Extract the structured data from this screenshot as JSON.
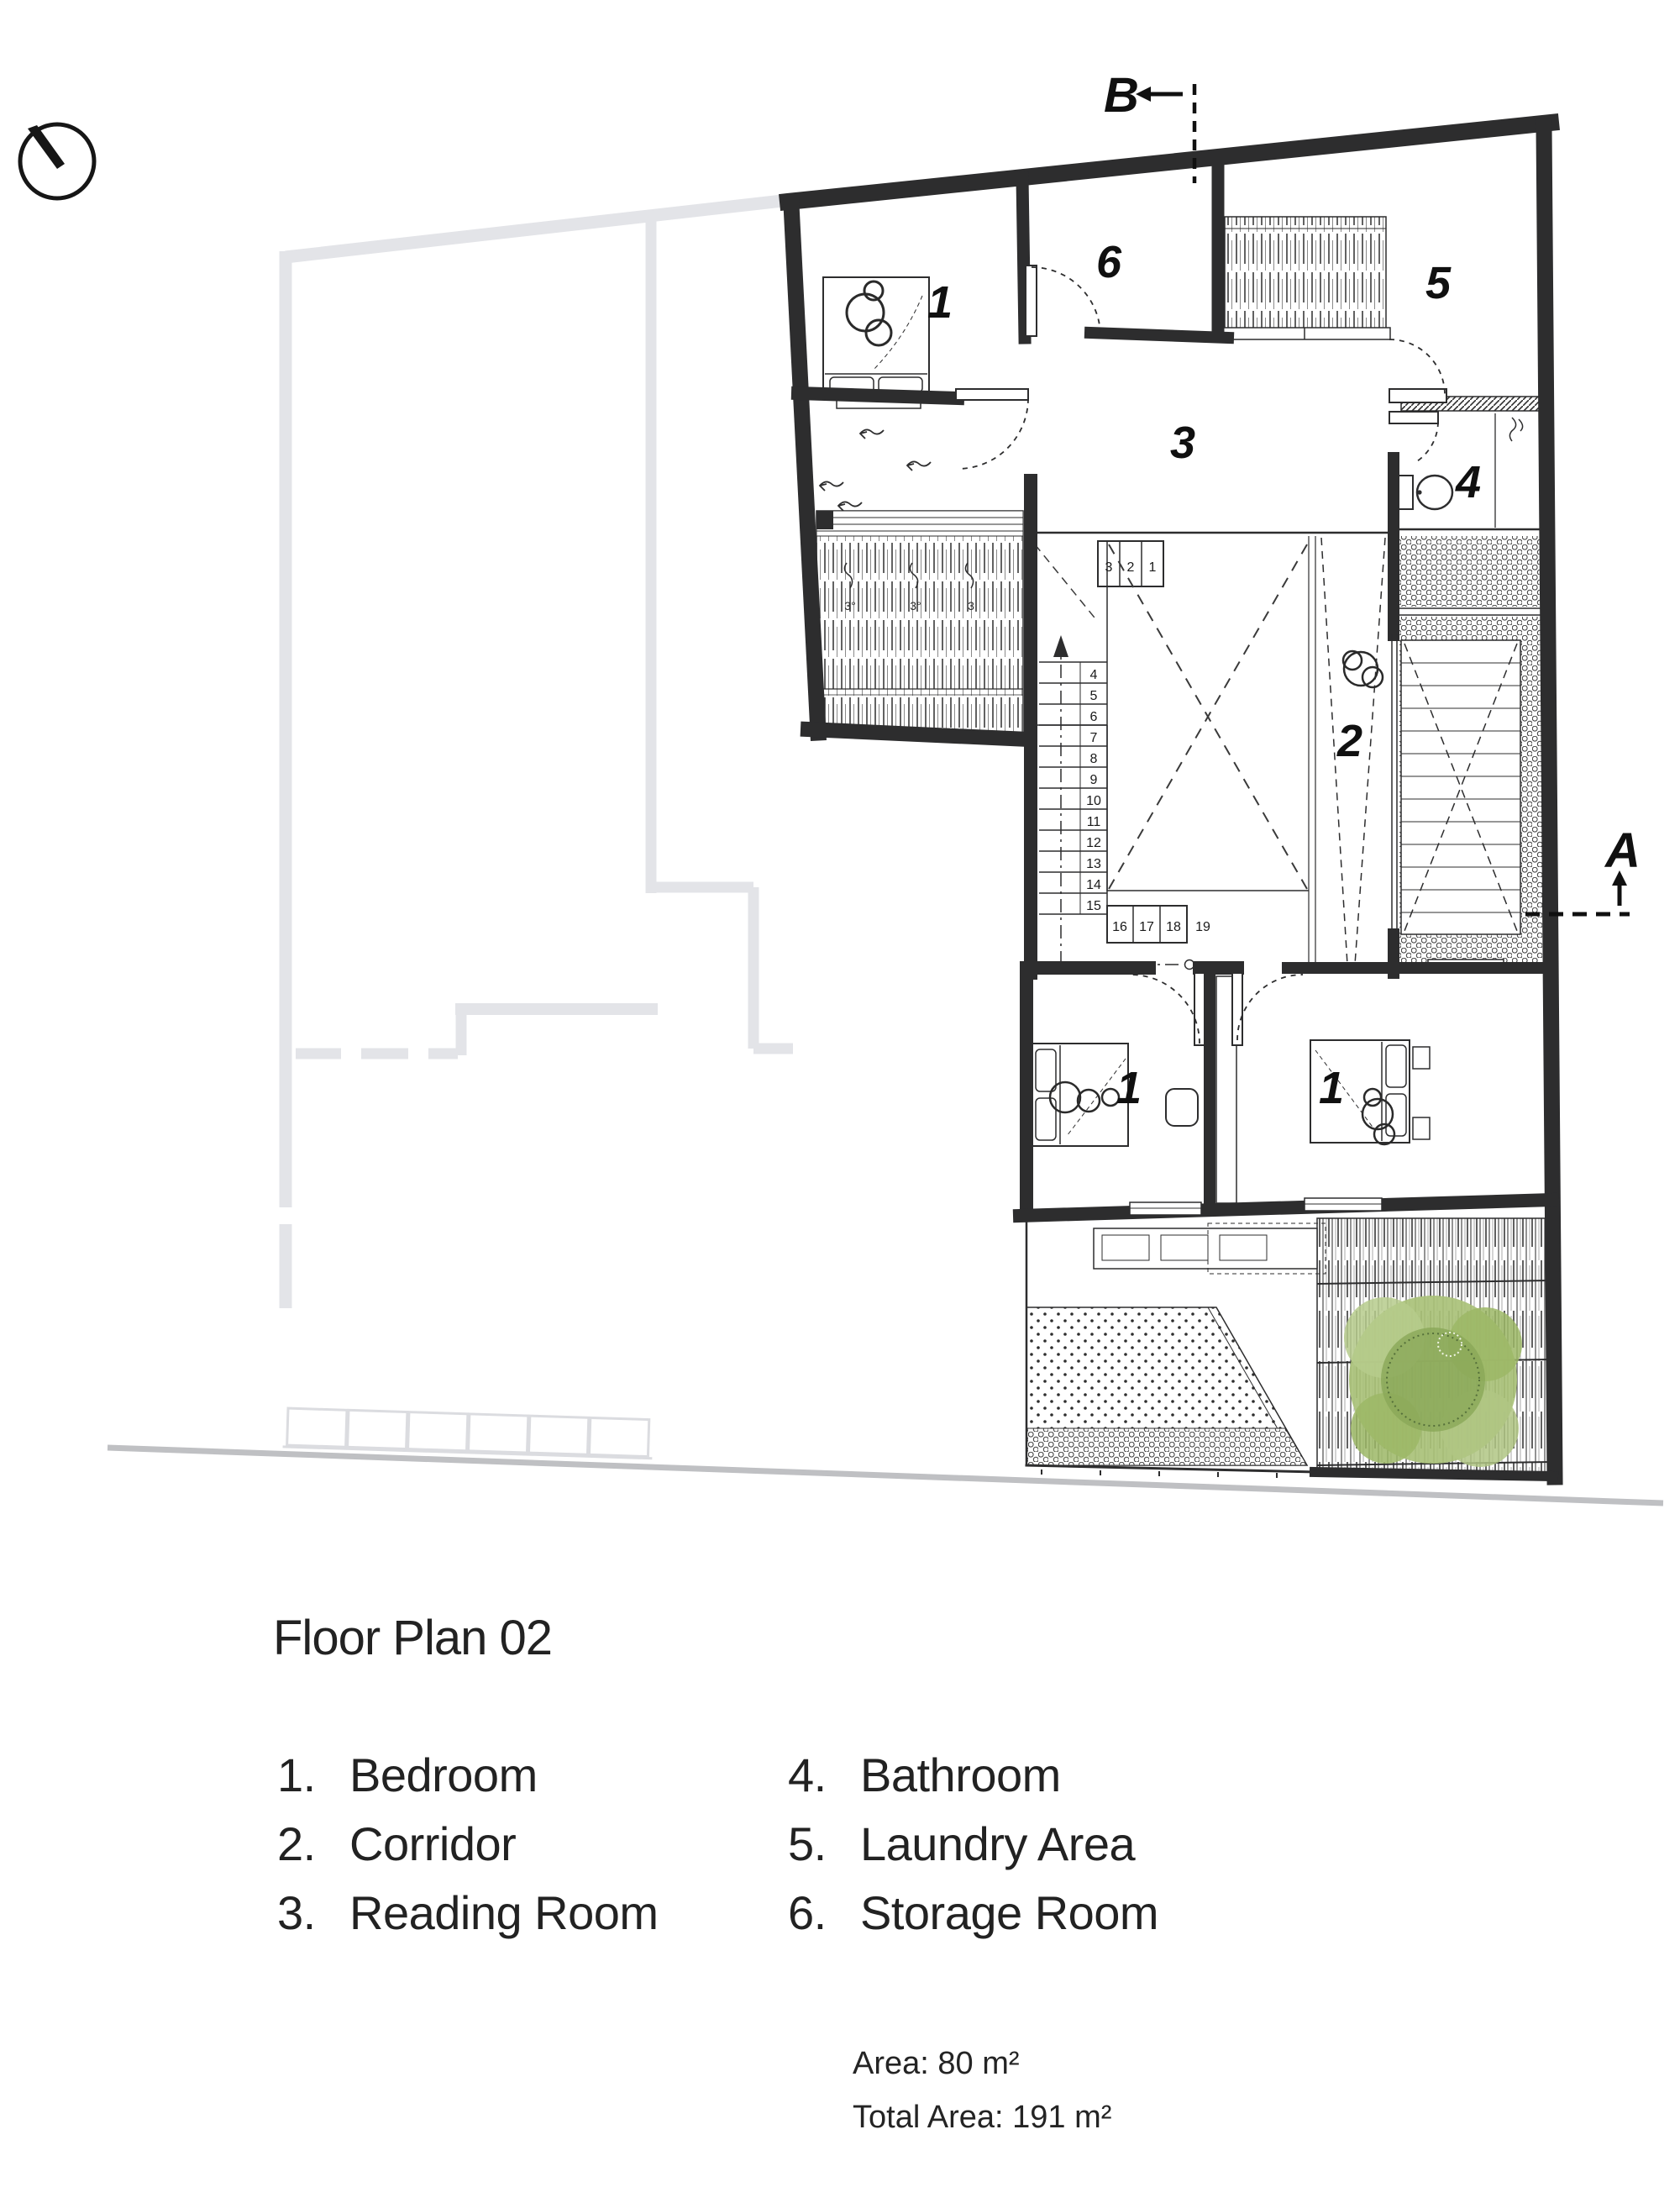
{
  "title_block": {
    "title": "Floor Plan 02"
  },
  "legend": {
    "items": [
      {
        "num": "1.",
        "label": "Bedroom"
      },
      {
        "num": "2.",
        "label": "Corridor"
      },
      {
        "num": "3.",
        "label": "Reading Room"
      },
      {
        "num": "4.",
        "label": "Bathroom"
      },
      {
        "num": "5.",
        "label": "Laundry Area"
      },
      {
        "num": "6.",
        "label": "Storage Room"
      }
    ]
  },
  "areas": {
    "area": "Area: 80 m²",
    "total_area": "Total Area: 191 m²"
  },
  "section_markers": {
    "top": "B",
    "right": "A"
  },
  "room_labels": [
    {
      "id": "bedroom-top",
      "text": "1"
    },
    {
      "id": "storage-room",
      "text": "6"
    },
    {
      "id": "laundry-area",
      "text": "5"
    },
    {
      "id": "reading-room",
      "text": "3"
    },
    {
      "id": "bathroom",
      "text": "4"
    },
    {
      "id": "corridor",
      "text": "2"
    },
    {
      "id": "bedroom-left",
      "text": "1"
    },
    {
      "id": "bedroom-right",
      "text": "1"
    }
  ],
  "stairs": {
    "top_run": [
      "3",
      "2",
      "1"
    ],
    "mid_run": [
      "4",
      "5",
      "6",
      "7",
      "8",
      "9",
      "10",
      "11",
      "12",
      "13",
      "14",
      "15"
    ],
    "bottom_run": [
      "16",
      "17",
      "18",
      "19"
    ]
  },
  "louver_marks": [
    "3°",
    "3°",
    "3"
  ],
  "colors": {
    "wall": "#2d2d2e",
    "ghost": "#e3e4e8",
    "ground": "#bfc0c3",
    "tree_green": "#a9c178",
    "text": "#1f1f1f"
  }
}
